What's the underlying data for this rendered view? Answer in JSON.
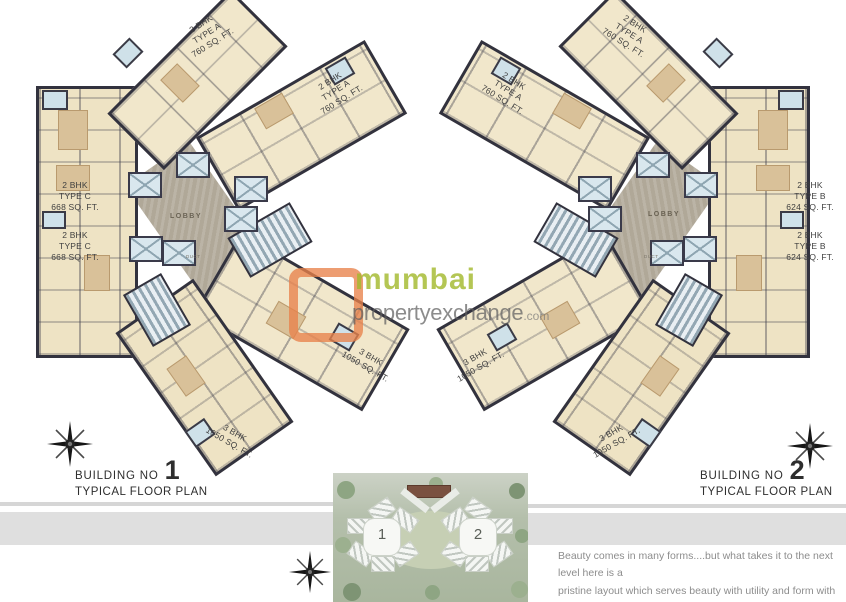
{
  "watermark": {
    "brand_top": "mumbai",
    "brand_bottom": "propertyexchange",
    "brand_suffix": ".com",
    "logo_color": "#e8824e",
    "brand_green": "#a3b92e",
    "brand_gray": "#5f5f5f"
  },
  "buildings": [
    {
      "title_prefix": "BUILDING NO",
      "number": "1",
      "subtitle": "TYPICAL FLOOR PLAN",
      "lobby": "LOBBY",
      "duct": "DUCT",
      "units": [
        {
          "name": "2bhk-type-a-top",
          "lines": [
            "2 BHK",
            "TYPE A",
            "760 SQ. FT."
          ]
        },
        {
          "name": "2bhk-type-a-right",
          "lines": [
            "2 BHK",
            "TYPE A",
            "760 SQ. FT."
          ]
        },
        {
          "name": "2bhk-type-c-upper",
          "lines": [
            "2 BHK",
            "TYPE C",
            "668 SQ. FT."
          ]
        },
        {
          "name": "2bhk-type-c-lower",
          "lines": [
            "2 BHK",
            "TYPE C",
            "668 SQ. FT."
          ]
        },
        {
          "name": "3bhk-right",
          "lines": [
            "3 BHK",
            "1050 SQ. FT."
          ]
        },
        {
          "name": "3bhk-bottom",
          "lines": [
            "3 BHK",
            "1050 SQ. FT."
          ]
        }
      ]
    },
    {
      "title_prefix": "BUILDING NO",
      "number": "2",
      "subtitle": "TYPICAL FLOOR PLAN",
      "lobby": "LOBBY",
      "duct": "DUCT",
      "units": [
        {
          "name": "2bhk-type-a-top",
          "lines": [
            "2 BHK",
            "TYPE A",
            "760 SQ. FT."
          ]
        },
        {
          "name": "2bhk-type-a-left",
          "lines": [
            "2 BHK",
            "TYPE A",
            "760 SQ. FT."
          ]
        },
        {
          "name": "2bhk-type-b-upper",
          "lines": [
            "2 BHK",
            "TYPE B",
            "624 SQ. FT."
          ]
        },
        {
          "name": "2bhk-type-b-lower",
          "lines": [
            "2 BHK",
            "TYPE B",
            "624 SQ. FT."
          ]
        },
        {
          "name": "3bhk-left",
          "lines": [
            "3 BHK",
            "1050 SQ. FT."
          ]
        },
        {
          "name": "3bhk-bottom",
          "lines": [
            "3 BHK",
            "1050 SQ. FT."
          ]
        }
      ]
    }
  ],
  "site_plan": {
    "labels": [
      "1",
      "2"
    ]
  },
  "caption": {
    "line1": "Beauty comes in many forms....but what takes it to the next level here is a",
    "line2": "pristine layout which serves beauty with utility and form with function."
  },
  "colors": {
    "wall": "#32323e",
    "room_fill": "#f1e7cb",
    "lift_blue": "#d9e7ee",
    "lobby_gray": "#b0a898",
    "site_green": "#aab79f"
  }
}
